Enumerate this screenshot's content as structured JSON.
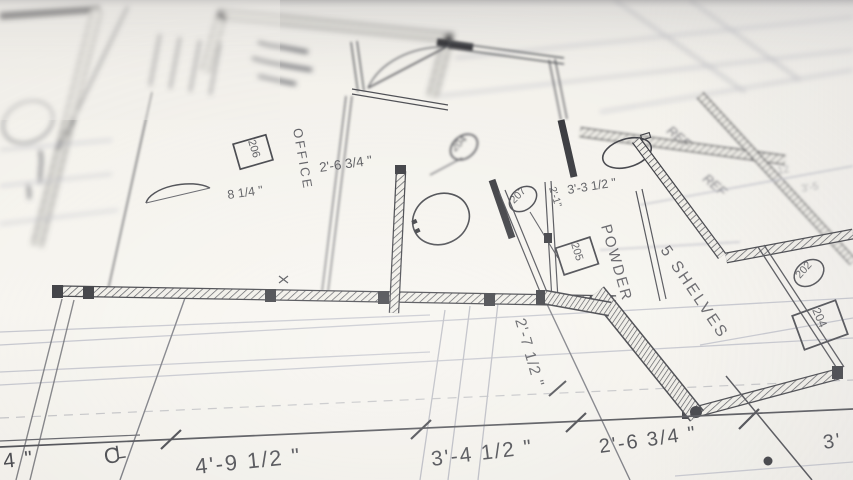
{
  "colors": {
    "paper": "#f2f0ea",
    "ink": "#2c2d33",
    "faint_line": "#c5c6ce"
  },
  "plan": {
    "room_labels": {
      "office": "OFFICE",
      "powder": "POWDER",
      "shelves": "5 SHELVES"
    },
    "room_tags": {
      "office_box": "206",
      "powder_box": "205",
      "closet_box": "204"
    },
    "door_tags": {
      "office_door": "204",
      "bath_door": "207",
      "closet_door": "202"
    },
    "dimensions": {
      "office_width": "2'-6 3/4 \"",
      "office_offset": "8 1/4 \"",
      "powder_width": "3'-3 1/2 \"",
      "door_offset": "2'-1\"",
      "hall_width": "2'-7 1/2 \"",
      "bottom_left_partial": "4 \"",
      "bottom_1": "4'-9 1/2 \"",
      "bottom_2": "3'-4 1/2 \"",
      "bottom_3": "2'-6 3/4 \"",
      "bottom_4": "3'"
    },
    "notes": {
      "ref_upper": "REF",
      "ref_lower": "REF",
      "faint_dim_a": "12",
      "faint_dim_b": "3'-5"
    },
    "centerline": {
      "c": "C",
      "l": "L"
    }
  }
}
